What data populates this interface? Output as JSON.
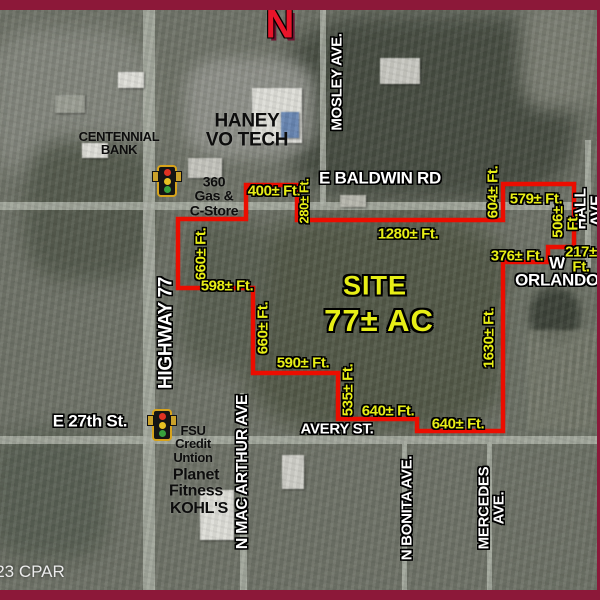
{
  "colors": {
    "border": "#8c1839",
    "boundary": "#ec0d00",
    "dimension_yellow": "#e7ee16",
    "north_red": "#e8142a"
  },
  "compass": {
    "letter": "N"
  },
  "credit": {
    "text": "23 CPAR"
  },
  "site": {
    "title": "SITE",
    "acreage": "77± AC"
  },
  "boundary": {
    "color": "#ec0d00",
    "points": "246,185 297,185 297,220 503,220 503,184 574,184 574,247 548,247 548,262 503,262 503,431 417,431 417,419 338,419 338,373 253,373 253,288 178,288 178,219 246,219"
  },
  "labels": [
    {
      "name": "street-mosley-ave",
      "cls": "street",
      "text": "MOSLEY AVE.",
      "x": 337,
      "y": 82,
      "rot": -90,
      "size": 15
    },
    {
      "name": "street-e-baldwin-rd",
      "cls": "street",
      "text": "E BALDWIN RD",
      "x": 380,
      "y": 178,
      "rot": 0,
      "size": 17
    },
    {
      "name": "street-hall-ave",
      "cls": "street",
      "text": "HALL AVE.",
      "x": 590,
      "y": 209,
      "rot": -90,
      "size": 16
    },
    {
      "name": "street-w-orlando",
      "cls": "street",
      "text": "W ORLANDO",
      "x": 557,
      "y": 272,
      "rot": 0,
      "size": 17
    },
    {
      "name": "street-highway-77",
      "cls": "street",
      "text": "HIGHWAY 77",
      "x": 166,
      "y": 333,
      "rot": -90,
      "size": 19
    },
    {
      "name": "street-e-27th-st",
      "cls": "street",
      "text": "E 27th St.",
      "x": 90,
      "y": 421,
      "rot": 0,
      "size": 17
    },
    {
      "name": "street-avery-st",
      "cls": "street",
      "text": "AVERY ST.",
      "x": 337,
      "y": 429,
      "rot": 0,
      "size": 15
    },
    {
      "name": "street-n-mac-arthur-ave",
      "cls": "street",
      "text": "N MAC ARTHUR AVE",
      "x": 243,
      "y": 472,
      "rot": -90,
      "size": 16
    },
    {
      "name": "street-n-bonita-ave",
      "cls": "street",
      "text": "N BONITA AVE.",
      "x": 407,
      "y": 508,
      "rot": -90,
      "size": 15
    },
    {
      "name": "street-mercedes-ave",
      "cls": "street",
      "text": "MERCEDES AVE.",
      "x": 492,
      "y": 508,
      "rot": -90,
      "size": 15
    },
    {
      "name": "dim-400-ft",
      "cls": "dim",
      "text": "400± Ft.",
      "x": 274,
      "y": 191,
      "rot": 0
    },
    {
      "name": "dim-280-ft",
      "cls": "dim",
      "text": "280± Ft.",
      "x": 304,
      "y": 201,
      "rot": -90,
      "size": 13
    },
    {
      "name": "dim-1280-ft",
      "cls": "dim",
      "text": "1280± Ft.",
      "x": 408,
      "y": 234,
      "rot": 0
    },
    {
      "name": "dim-604-ft",
      "cls": "dim",
      "text": "604± Ft.",
      "x": 493,
      "y": 192,
      "rot": -90
    },
    {
      "name": "dim-579-ft",
      "cls": "dim",
      "text": "579± Ft.",
      "x": 536,
      "y": 199,
      "rot": 0
    },
    {
      "name": "dim-506-ft",
      "cls": "dim",
      "text": "506± Ft.",
      "x": 566,
      "y": 222,
      "rot": -90
    },
    {
      "name": "dim-376-ft",
      "cls": "dim",
      "text": "376± Ft.",
      "x": 517,
      "y": 256,
      "rot": 0
    },
    {
      "name": "dim-217-ft",
      "cls": "dim",
      "text": "217± Ft.",
      "x": 581,
      "y": 260,
      "rot": 0
    },
    {
      "name": "dim-660-ft-north",
      "cls": "dim",
      "text": "660± Ft.",
      "x": 201,
      "y": 254,
      "rot": -90
    },
    {
      "name": "dim-598-ft",
      "cls": "dim",
      "text": "598± Ft.",
      "x": 227,
      "y": 286,
      "rot": 0
    },
    {
      "name": "dim-660-ft-south",
      "cls": "dim",
      "text": "660± Ft.",
      "x": 263,
      "y": 328,
      "rot": -90
    },
    {
      "name": "dim-590-ft",
      "cls": "dim",
      "text": "590± Ft.",
      "x": 303,
      "y": 363,
      "rot": 0
    },
    {
      "name": "dim-535-ft",
      "cls": "dim",
      "text": "535± Ft.",
      "x": 348,
      "y": 390,
      "rot": -90
    },
    {
      "name": "dim-640-ft-west",
      "cls": "dim",
      "text": "640± Ft.",
      "x": 388,
      "y": 411,
      "rot": 0
    },
    {
      "name": "dim-640-ft-east",
      "cls": "dim",
      "text": "640± Ft.",
      "x": 458,
      "y": 424,
      "rot": 0
    },
    {
      "name": "dim-1630-ft",
      "cls": "dim",
      "text": "1630± Ft.",
      "x": 489,
      "y": 338,
      "rot": -90
    },
    {
      "name": "place-centennial-bank",
      "cls": "place",
      "text": "CENTENNIAL\nBANK",
      "x": 119,
      "y": 143,
      "rot": 0,
      "size": 13
    },
    {
      "name": "place-haney-vo-tech",
      "cls": "place",
      "text": "HANEY\nVO TECH",
      "x": 247,
      "y": 131,
      "rot": 0,
      "size": 19
    },
    {
      "name": "place-360-gas-c-store",
      "cls": "place",
      "text": "360\nGas &\nC-Store",
      "x": 214,
      "y": 196,
      "rot": 0,
      "size": 14
    },
    {
      "name": "place-fsu-credit-union",
      "cls": "place",
      "text": "FSU\nCredit\nUntion",
      "x": 193,
      "y": 444,
      "rot": 0,
      "size": 13
    },
    {
      "name": "place-planet-fitness",
      "cls": "place",
      "text": "Planet\nFitness",
      "x": 196,
      "y": 484,
      "rot": 0,
      "size": 16
    },
    {
      "name": "place-kohls",
      "cls": "place",
      "text": "KOHL'S",
      "x": 199,
      "y": 509,
      "rot": 0,
      "size": 16
    }
  ],
  "traffic_lights": [
    {
      "name": "traffic-light-baldwin",
      "x": 167,
      "y": 181
    },
    {
      "name": "traffic-light-27th",
      "x": 162,
      "y": 425
    }
  ]
}
